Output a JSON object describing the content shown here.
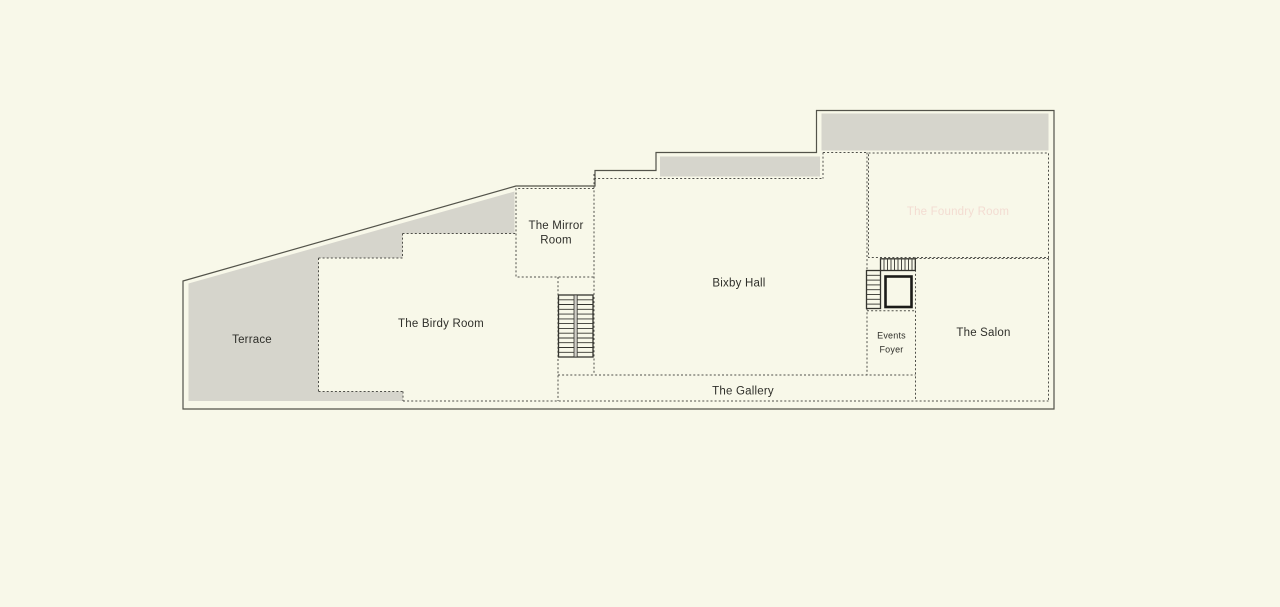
{
  "plan": {
    "rooms": {
      "terrace": "Terrace",
      "birdy": "The Birdy Room",
      "mirror_line1": "The Mirror",
      "mirror_line2": "Room",
      "bixby": "Bixby Hall",
      "foundry": "The Foundry Room",
      "events_line1": "Events",
      "events_line2": "Foyer",
      "salon": "The Salon",
      "gallery": "The Gallery"
    },
    "colors": {
      "background": "#F8F8E9",
      "terrace_fill": "#D6D5CC",
      "highlight_fill": "#A93B20",
      "highlight_text": "#F3DCD2",
      "label_text": "#2F2F2A"
    }
  }
}
